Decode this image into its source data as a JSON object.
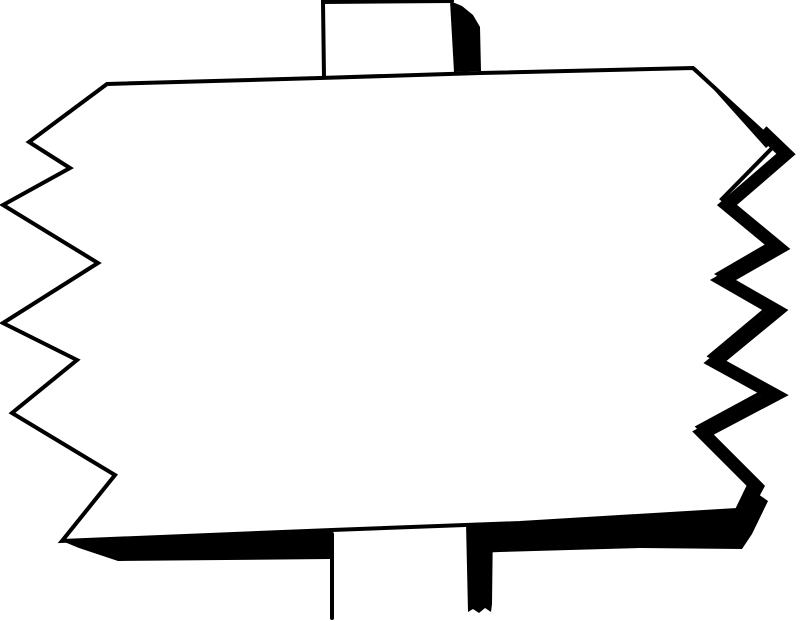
{
  "artwork": {
    "title": "Blank signpost clipart",
    "description": "Black and white line drawing of a blank rectangular sign board with torn zigzag left and right edges, thick black shadow along the right and bottom edges, mounted on a wooden post that shows above and below the board.",
    "colors": {
      "ink": "#000000",
      "paper": "#ffffff"
    },
    "paths": {
      "bottom_shadow_band": "M62,541 L332,530 L520,523 L730,512 L748,487 L768,501 L752,534 L742,549 L640,548 L500,552 L330,559 L118,561 L79,548 Z",
      "bottom_post_face": "M332,528 L468,523 L468,616 L332,620 Z",
      "bottom_post_edge": "M332,534 L332,618",
      "bottom_post_shadow_bar": "M466,523 L493,522 L492,604 L491,612 L485,608 L479,613 L473,609 L468,612 Z",
      "top_post_face": "M322,2 L452,1 L456,72 L324,79 Z",
      "top_post_edges": "M324,78 L323,2 L452,1",
      "top_post_shadow": "M450,1 L462,6 L473,15 L480,27 L481,71 L454,72 Z",
      "board_outline": "M107,84 L320,78 L480,73 L693,68 L776,144 L722,199 L773,242 L718,274 L771,305 L710,356 L768,389 L698,427 L751,481 L737,510 L520,523 L332,530 L62,541 L115,475 L12,413 L77,360 L3,323 L98,263 L3,205 L70,168 L29,142 Z",
      "right_shadow_wedge": "M695,67 L774,141 L766,148 L698,72 Z",
      "right_shadow_band": "M762,131 L786,154 L727,205 L779,248 L723,280 L777,311 L715,362 L775,395 L703,433 L757,487 L743,513 L724,523"
    }
  }
}
